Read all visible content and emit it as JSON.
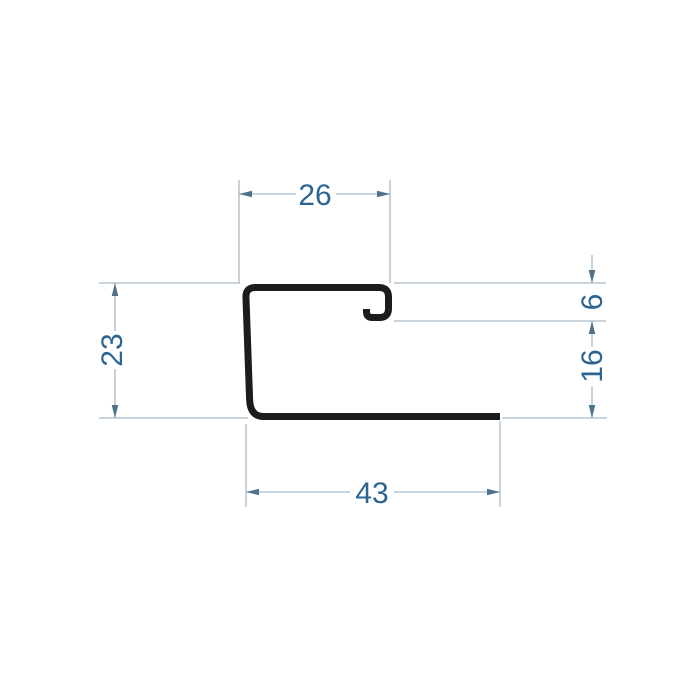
{
  "drawing": {
    "kind": "profile-cross-section-dimensioned-drawing",
    "dimensions": {
      "top_width": {
        "label": "26"
      },
      "left_height": {
        "label": "23"
      },
      "hook_opening": {
        "label": "6"
      },
      "lip_height": {
        "label": "16"
      },
      "bottom_length": {
        "label": "43"
      }
    },
    "colors": {
      "profile_stroke": "#1c1c1c",
      "dimension_line": "#a9bac6",
      "arrowhead": "#4f7189",
      "label_text": "#2e6590",
      "background": "#ffffff"
    }
  }
}
